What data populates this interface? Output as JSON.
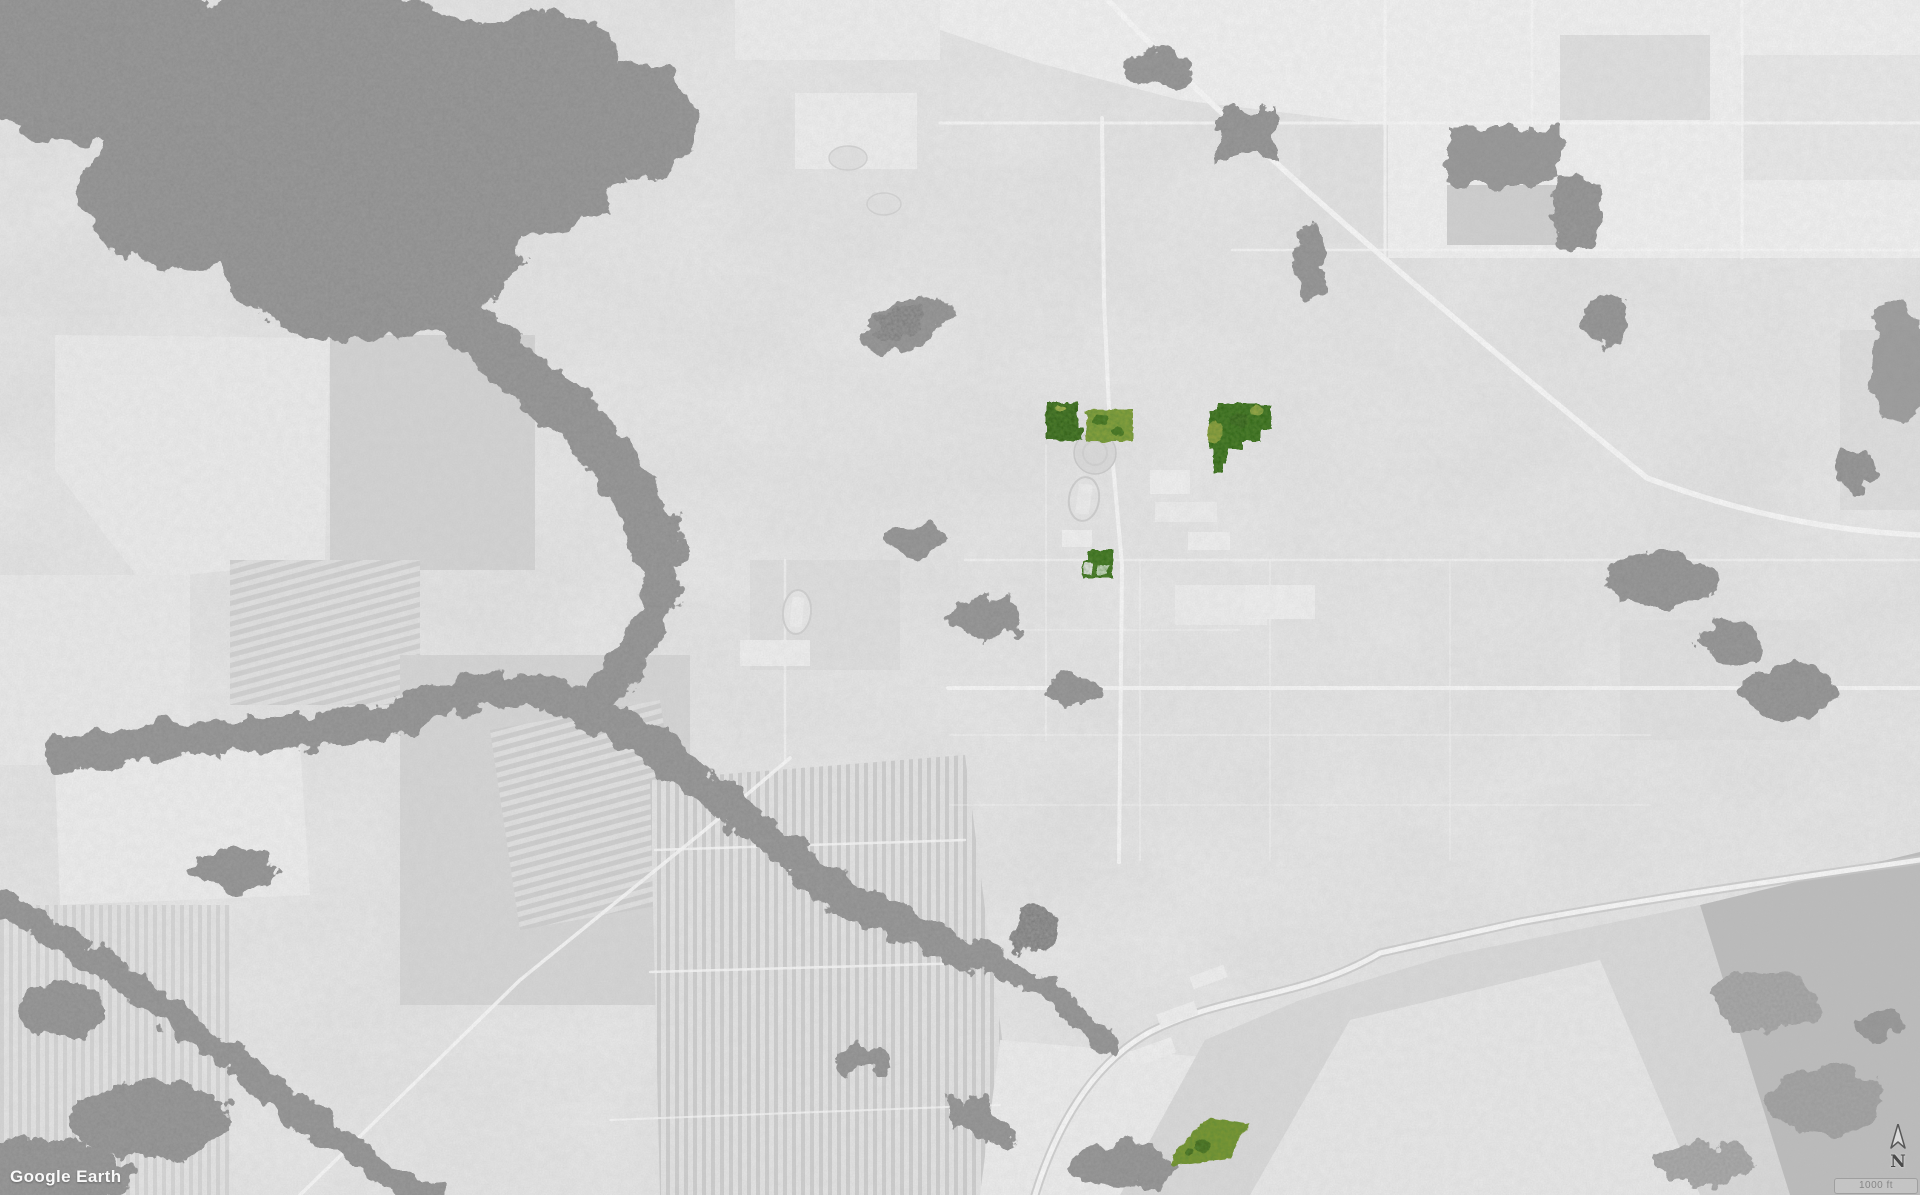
{
  "map": {
    "watermark": "Google Earth",
    "compass_label": "N",
    "scale_label": "1000 ft",
    "palette": {
      "base": "#e9e9e9",
      "forest": "#878787",
      "pond": "#6f6f6f",
      "road": "#ffffff",
      "field_light": "#f6f6f6",
      "marsh": "#bdbdbd"
    },
    "parcels": {
      "west_a": "#2e5c17",
      "west_b": "#8aa23f",
      "east": "#2d6414",
      "central": "#356b1c",
      "south": "#7f9734"
    }
  }
}
